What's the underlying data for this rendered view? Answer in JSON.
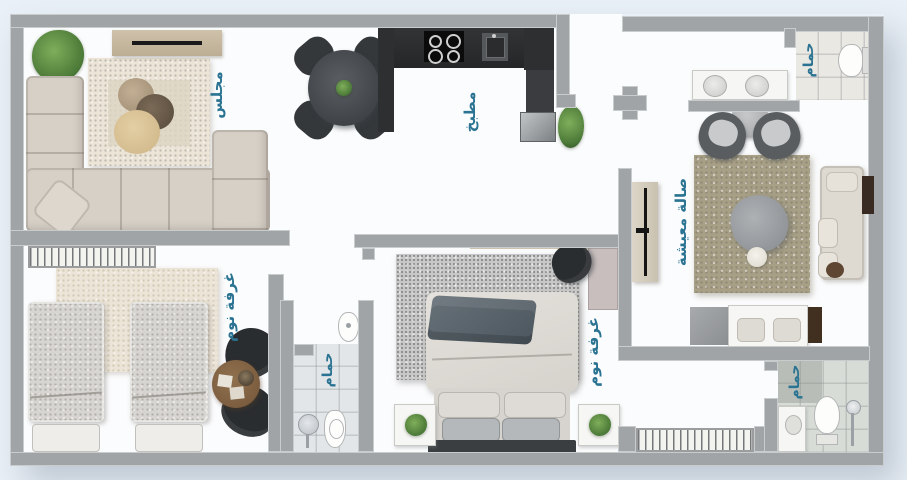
{
  "plan": {
    "colors": {
      "background": "#e9f0f7",
      "floor": "#fbfcfd",
      "wall": "#a1a4a6",
      "wall_edge": "#c9cccd",
      "label": "#2b7392",
      "counter": "#2d2f31",
      "sofa": "#d6d0c7",
      "rug_cream": "#ebe4d7",
      "rug_living": "#a79f86",
      "rug_gray": "#c8c8c8",
      "tile_warm": "#eae8e3",
      "tile_cool": "#e2e6e8",
      "tile_green": "#d8dcd6",
      "wood": "#7c5d3f",
      "plant": "#4c7a38",
      "dark_seat": "#2a2d30",
      "white_fixture": "#f6f6f4",
      "slate": "#5a646c"
    },
    "rooms": {
      "majlis": {
        "label": "مجلس"
      },
      "kitchen": {
        "label": "مطبخ"
      },
      "bathroom_top": {
        "label": "حمام"
      },
      "living_hall": {
        "label": "صالة معيشة"
      },
      "bedroom_twin": {
        "label": "غرفة نوم"
      },
      "bathroom_middle": {
        "label": "حمام"
      },
      "bedroom_master": {
        "label": "غرفة نوم"
      },
      "bathroom_bottom": {
        "label": "حمام"
      }
    }
  }
}
